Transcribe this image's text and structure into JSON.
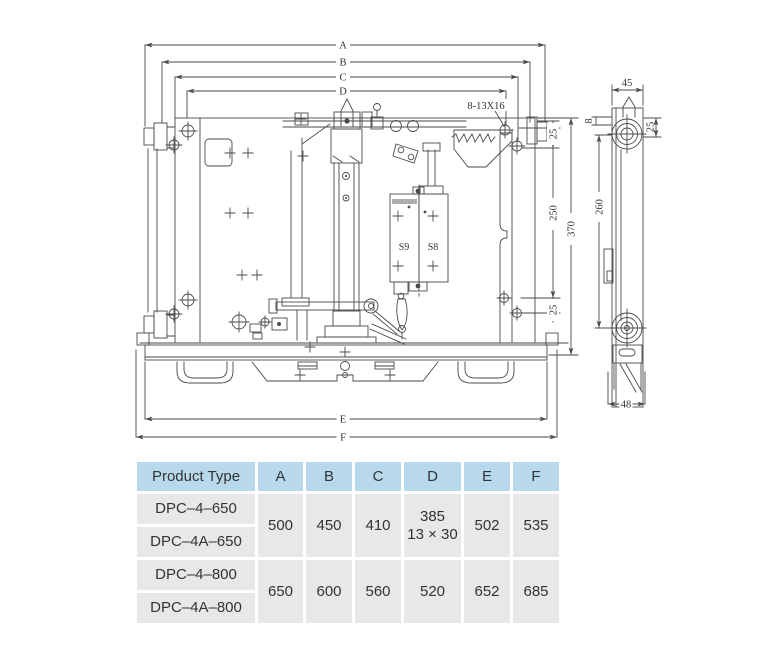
{
  "drawing": {
    "top_dims": [
      "A",
      "B",
      "C",
      "D"
    ],
    "bottom_dims": [
      "E",
      "F"
    ],
    "callout_hole": "8-13X16",
    "dim_25_top": "25",
    "dim_250": "250",
    "dim_370": "370",
    "dim_25_bottom": "25",
    "switch_left": "S9",
    "switch_right": "S8",
    "side_view": {
      "width_top": "45",
      "offset_8": "8",
      "offset_25": "25",
      "height_260": "260",
      "width_bottom": "48"
    }
  },
  "table": {
    "headers": [
      "Product Type",
      "A",
      "B",
      "C",
      "D",
      "E",
      "F"
    ],
    "groups": [
      {
        "model_top": "DPC–4–650",
        "model_bottom": "DPC–4A–650",
        "a": "500",
        "b": "450",
        "c": "410",
        "d_line1": "385",
        "d_line2": "13 × 30",
        "e": "502",
        "f": "535"
      },
      {
        "model_top": "DPC–4–800",
        "model_bottom": "DPC–4A–800",
        "a": "650",
        "b": "600",
        "c": "560",
        "d_line1": "520",
        "d_line2": "",
        "e": "652",
        "f": "685"
      }
    ]
  },
  "colors": {
    "header_bg": "#b7d9eb",
    "cell_bg": "#e9e8e8",
    "line": "#4a4a4a",
    "text": "#333333"
  }
}
